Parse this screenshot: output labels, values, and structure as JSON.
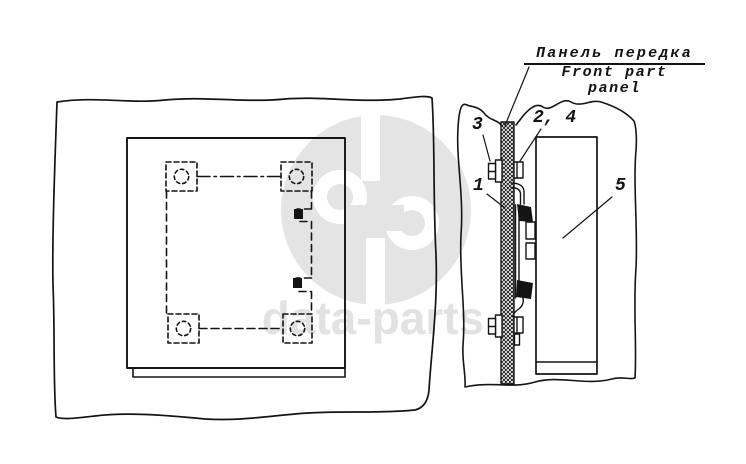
{
  "figure": {
    "kind": "parts-catalog-technical-diagram",
    "line_color": "#141414",
    "background_color": "#ffffff"
  },
  "labels": {
    "panel_ru": "Панель передка",
    "panel_en_line1": "Front part",
    "panel_en_line2": "panel"
  },
  "callouts": {
    "c3": "3",
    "c24": "2, 4",
    "c1": "1",
    "c5": "5"
  },
  "watermark": {
    "text": "data-parts",
    "color": "#e2e2e2",
    "logo": "data-parts-logo"
  }
}
